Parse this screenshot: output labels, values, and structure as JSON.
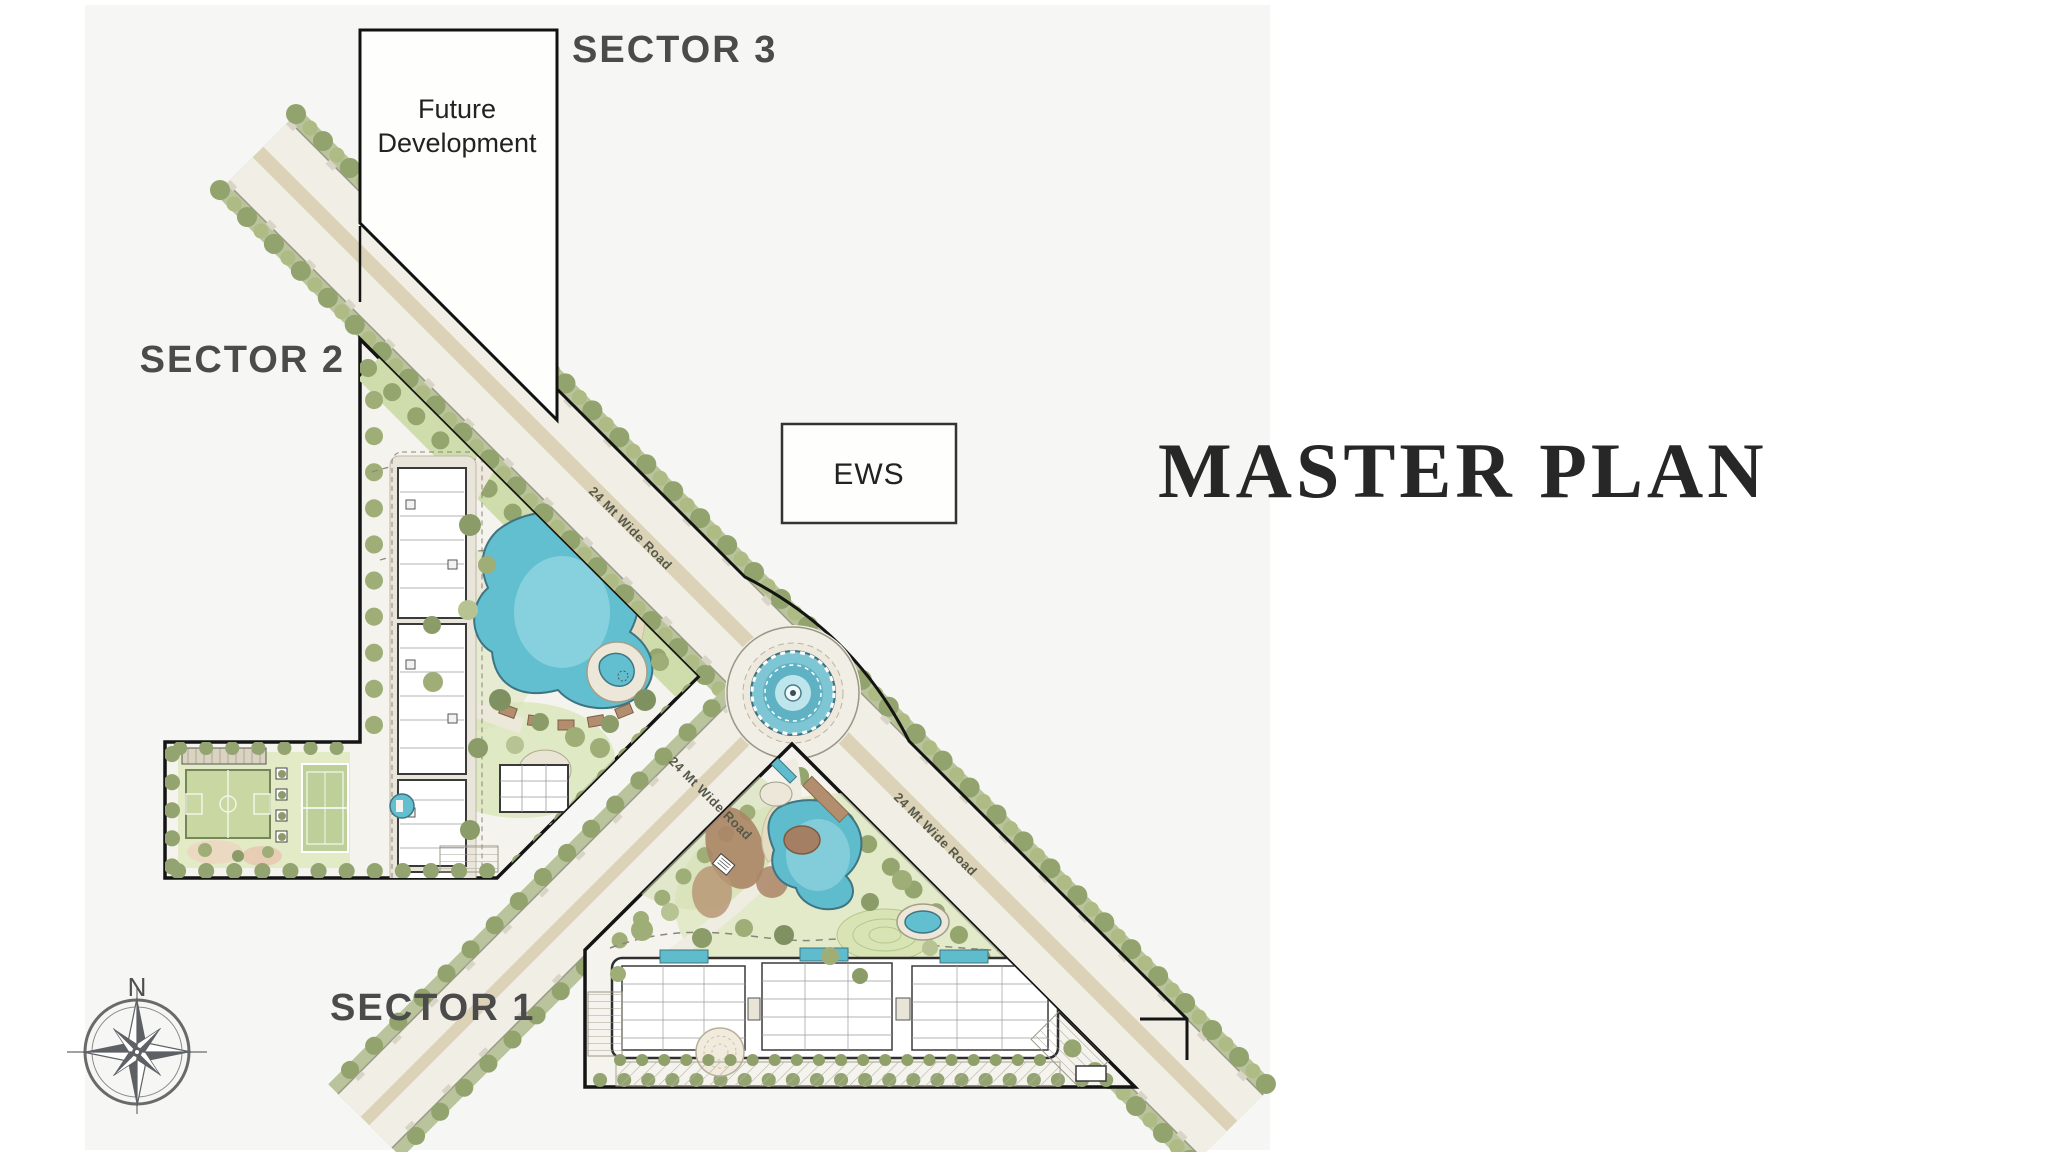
{
  "title": {
    "text": "MASTER PLAN"
  },
  "sector_labels": {
    "sector1": "SECTOR 1",
    "sector2": "SECTOR 2",
    "sector3": "SECTOR 3"
  },
  "parcels": {
    "future_development": {
      "line1": "Future",
      "line2": "Development"
    },
    "ews": {
      "label": "EWS"
    }
  },
  "roads": {
    "wide_road_label": "24 Mt Wide Road"
  },
  "compass": {
    "north_label": "N"
  },
  "colors": {
    "label_gray": "#4b4b4b",
    "title_black": "#272727",
    "boundary_black": "#141414",
    "road_surface": "#f1eee5",
    "road_median_tan": "#dcd2b8",
    "verge_green": "#b9c49c",
    "tree_green": "#8b9c68",
    "lawn_green": "#d3dfb0",
    "pool_teal": "#62bfd0",
    "deck_tan": "#e6dcc2",
    "mulch_brown": "#ab8566",
    "plot_base": "#f4f3ed"
  }
}
